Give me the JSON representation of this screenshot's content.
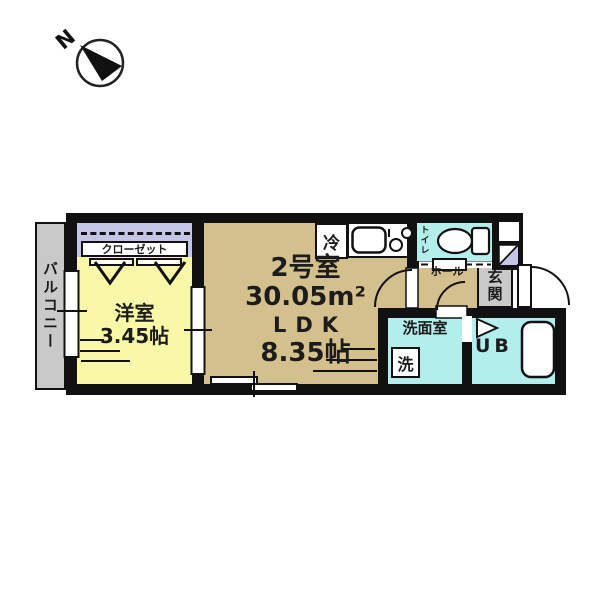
{
  "compass": {
    "north_label": "N"
  },
  "rooms": {
    "balcony": {
      "label": "バルコニー"
    },
    "closet": {
      "label": "クローゼット"
    },
    "western_room": {
      "label": "洋室",
      "size": "3.45帖"
    },
    "main_room": {
      "number": "2号室",
      "area": "30.05m²",
      "layout": "LDK",
      "size": "8.35帖"
    },
    "kitchen": {
      "fridge_label": "冷"
    },
    "toilet": {
      "label": "トイレ"
    },
    "hall": {
      "label": "ホール"
    },
    "entrance": {
      "label": "玄関"
    },
    "washroom": {
      "label": "洗面室",
      "washer_label": "洗"
    },
    "unit_bath": {
      "label": "UB"
    }
  },
  "colors": {
    "wall": "#111111",
    "balcony_gray": "#c9c9c9",
    "closet_lavender": "#c5c5e8",
    "room_yellow": "#f8f8a8",
    "ldk_tan": "#d4c08c",
    "wet_area_cyan": "#b2efec",
    "text": "#1c1c1c"
  }
}
